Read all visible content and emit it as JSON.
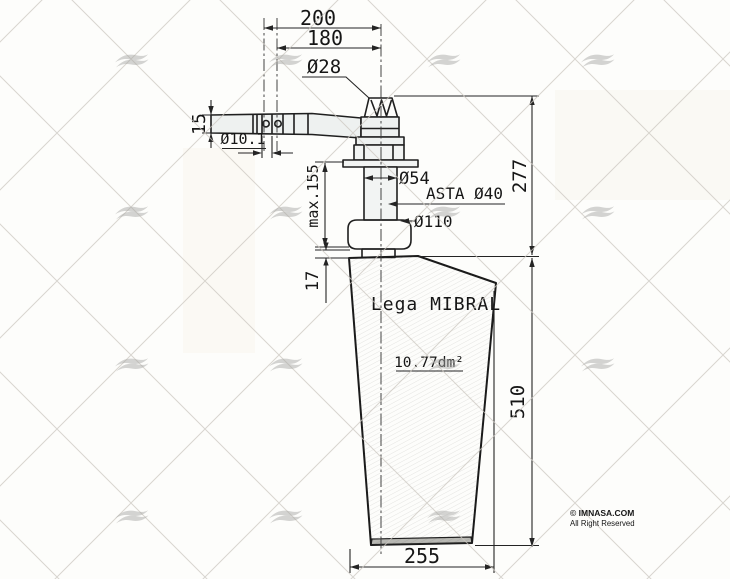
{
  "dimensions": {
    "top_width": "200",
    "top_width_inner": "180",
    "crown_diameter": "Ø28",
    "arm_thickness": "15",
    "pin_hole_diameter": "Ø10.1",
    "sleeve_diameter": "Ø54",
    "shaft_label": "ASTA Ø40",
    "flange_diameter": "Ø110",
    "shaft_max_length": "max.155",
    "upper_height": "277",
    "collar_height": "17",
    "body_height": "510",
    "body_width": "255"
  },
  "annotations": {
    "material": "Lega MIBRAL",
    "surface_area": "10.77dm²"
  },
  "footer": {
    "copyright": "© IMNASA.COM",
    "rights": "All Right Reserved"
  },
  "colors": {
    "line": "#1f1f1f",
    "dimension_line": "#242424",
    "background": "#fdfdfb",
    "watermark_wave": "#a9a9a6",
    "watermark_hatch": "#ccc8c1",
    "body_fill_light": "#f2f2ef",
    "body_fill_mid": "#e2e2dc",
    "body_fill_dark": "#cfcfc7"
  }
}
